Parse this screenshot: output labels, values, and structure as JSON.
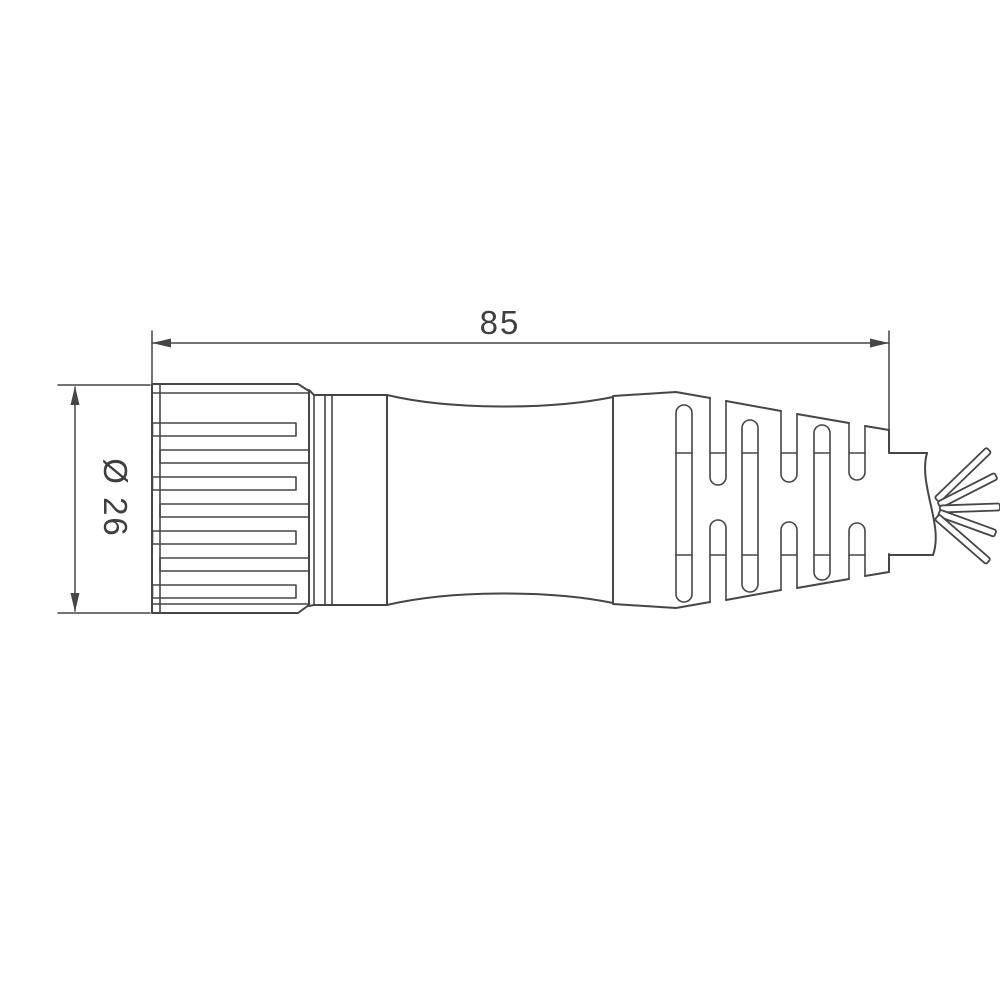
{
  "diagram": {
    "type": "technical-dimension-drawing",
    "subject": "circular-connector-with-cable-side-view",
    "dimensions": {
      "length": {
        "value": "85"
      },
      "diameter": {
        "value": "Ø 26"
      }
    },
    "colors": {
      "line": "#464646",
      "text": "#3f3f3f",
      "background": "#ffffff"
    }
  }
}
